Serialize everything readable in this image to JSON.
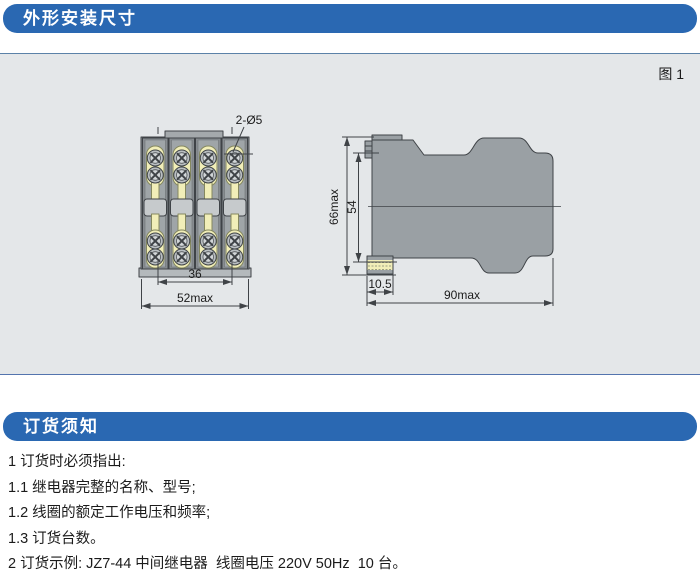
{
  "colors": {
    "header_bar": "#2a68b2",
    "header_text": "#ffffff",
    "panel_bg": "#e4e7e9",
    "panel_border": "#5b82a8",
    "drawing_gray": "#9aa0a4",
    "terminal_yellow": "#f1eeb8",
    "line": "#3f4347",
    "text": "#1b1b1b"
  },
  "section_dimensions": {
    "title": "外形安装尺寸"
  },
  "figure": {
    "label": "图 1",
    "front_view": {
      "hole_label": "2-Ø5",
      "width_inner": "36",
      "width_outer": "52max"
    },
    "side_view": {
      "height_outer": "66max",
      "height_inner": "54",
      "depth_terminal": "10.5",
      "depth_outer": "90max"
    }
  },
  "section_ordering": {
    "title": "订货须知"
  },
  "notes": {
    "lines": [
      "1 订货时必须指出:",
      "1.1 继电器完整的名称、型号;",
      "1.2 线圈的额定工作电压和频率;",
      "1.3 订货台数。",
      "2 订货示例: JZ7-44 中间继电器  线圈电压 220V 50Hz  10 台。"
    ]
  }
}
